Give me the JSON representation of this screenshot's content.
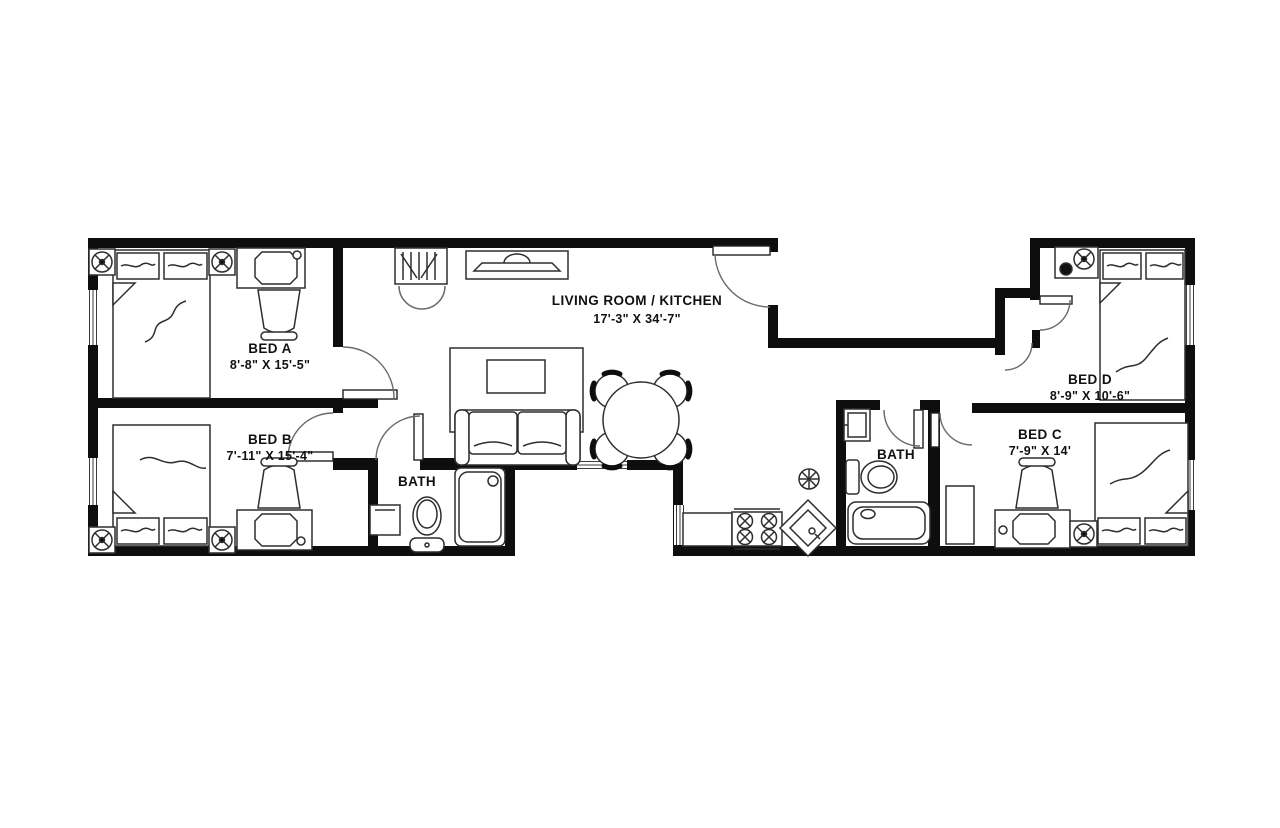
{
  "plan": {
    "type": "apartment-floor-plan",
    "rooms": {
      "bedA": {
        "name": "BED A",
        "dims": "8'-8\" X 15'-5\""
      },
      "bedB": {
        "name": "BED B",
        "dims": "7'-11\" X 15'-4\""
      },
      "bathLeft": {
        "name": "BATH"
      },
      "living": {
        "name": "LIVING ROOM / KITCHEN",
        "dims": "17'-3\" X 34'-7\""
      },
      "bathRight": {
        "name": "BATH"
      },
      "bedC": {
        "name": "BED C",
        "dims": "7'-9\" X 14'"
      },
      "bedD": {
        "name": "BED D",
        "dims": "8'-9\" X 10'-6\""
      }
    },
    "colors": {
      "wall": "#0e0e0e",
      "furniture_line": "#2e2e2e",
      "door_arc": "#6a6a6a",
      "background": "#ffffff"
    }
  }
}
